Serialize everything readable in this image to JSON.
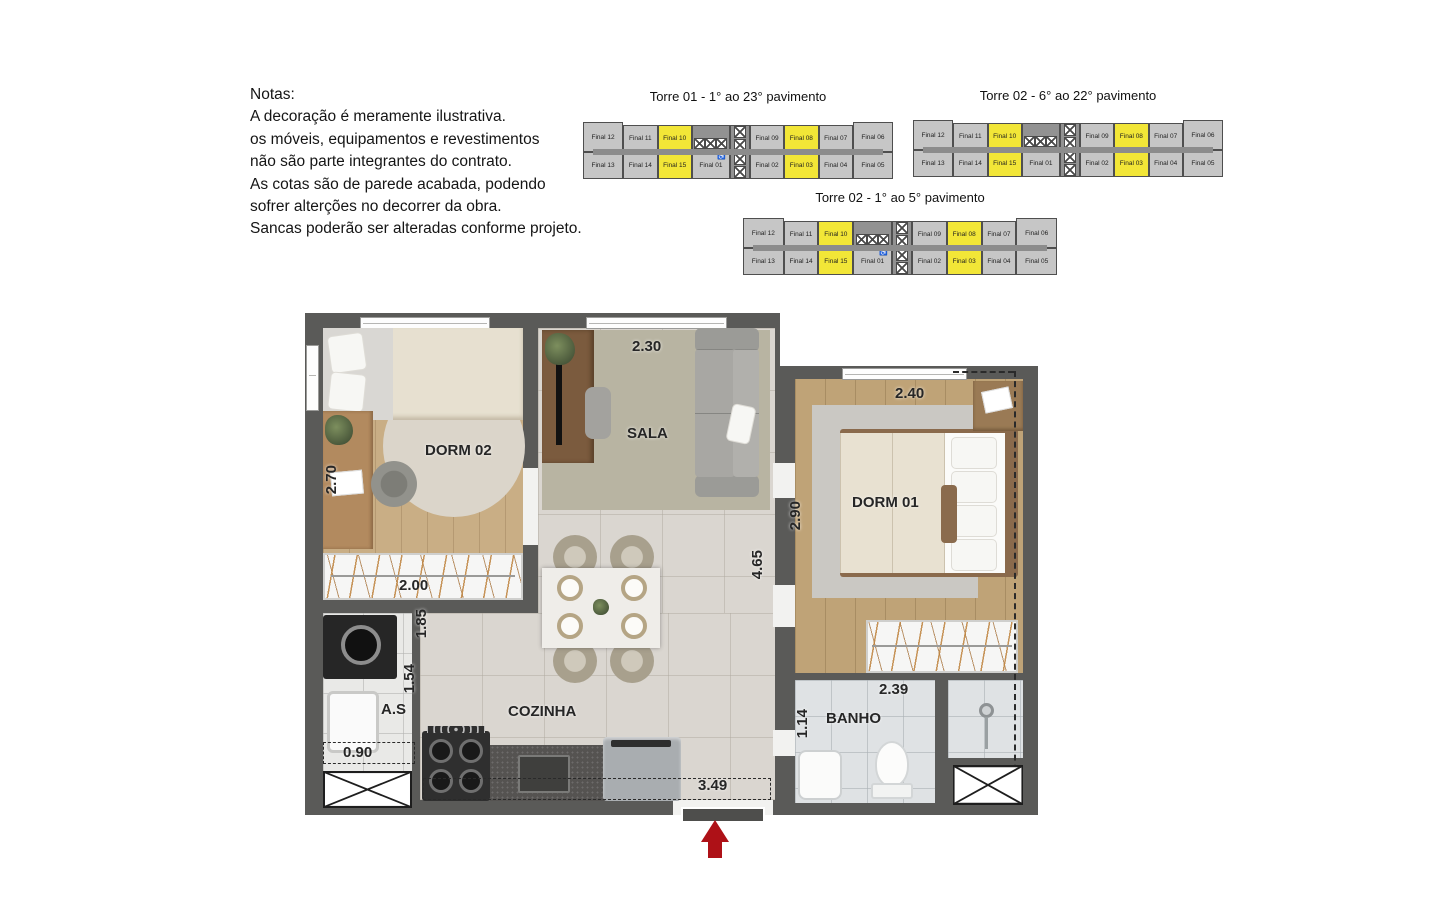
{
  "notes": {
    "title": "Notas:",
    "lines": [
      "A decoração é meramente ilustrativa.",
      "os móveis, equipamentos e revestimentos",
      "não são parte integrantes do contrato.",
      "As cotas são de parede acabada, podendo",
      "sofrer alterções no decorrer da obra.",
      "Sancas poderão ser alteradas conforme projeto."
    ]
  },
  "towers": [
    {
      "title": "Torre 01 - 1° ao 23° pavimento",
      "top_row": [
        {
          "label": "Final 12",
          "type": "unit",
          "end": true
        },
        {
          "label": "Final 11",
          "type": "unit"
        },
        {
          "label": "Final 10",
          "type": "unit",
          "hl": true
        },
        {
          "type": "stairs"
        },
        {
          "type": "elev"
        },
        {
          "label": "Final 09",
          "type": "unit"
        },
        {
          "label": "Final 08",
          "type": "unit",
          "hl": true
        },
        {
          "label": "Final 07",
          "type": "unit"
        },
        {
          "label": "Final 06",
          "type": "unit",
          "end": true
        }
      ],
      "bottom_row": [
        {
          "label": "Final 13",
          "type": "unit",
          "end": true
        },
        {
          "label": "Final 14",
          "type": "unit"
        },
        {
          "label": "Final 15",
          "type": "unit",
          "hl": true
        },
        {
          "label": "Final 01",
          "type": "unit",
          "f01": true,
          "acc": true
        },
        {
          "type": "elev"
        },
        {
          "label": "Final 02",
          "type": "unit"
        },
        {
          "label": "Final 03",
          "type": "unit",
          "hl": true
        },
        {
          "label": "Final 04",
          "type": "unit"
        },
        {
          "label": "Final 05",
          "type": "unit",
          "end": true
        }
      ]
    },
    {
      "title": "Torre 02 - 6° ao 22° pavimento",
      "top_row": [
        {
          "label": "Final 12",
          "type": "unit",
          "end": true
        },
        {
          "label": "Final 11",
          "type": "unit"
        },
        {
          "label": "Final 10",
          "type": "unit",
          "hl": true
        },
        {
          "type": "stairs"
        },
        {
          "type": "elev"
        },
        {
          "label": "Final 09",
          "type": "unit"
        },
        {
          "label": "Final 08",
          "type": "unit",
          "hl": true
        },
        {
          "label": "Final 07",
          "type": "unit"
        },
        {
          "label": "Final 06",
          "type": "unit",
          "end": true
        }
      ],
      "bottom_row": [
        {
          "label": "Final 13",
          "type": "unit",
          "end": true
        },
        {
          "label": "Final 14",
          "type": "unit"
        },
        {
          "label": "Final 15",
          "type": "unit",
          "hl": true
        },
        {
          "label": "Final 01",
          "type": "unit",
          "f01": true,
          "acc": false
        },
        {
          "type": "elev"
        },
        {
          "label": "Final 02",
          "type": "unit"
        },
        {
          "label": "Final 03",
          "type": "unit",
          "hl": true
        },
        {
          "label": "Final 04",
          "type": "unit"
        },
        {
          "label": "Final 05",
          "type": "unit",
          "end": true
        }
      ]
    },
    {
      "title": "Torre 02 - 1° ao 5° pavimento",
      "top_row": [
        {
          "label": "Final 12",
          "type": "unit",
          "end": true
        },
        {
          "label": "Final 11",
          "type": "unit"
        },
        {
          "label": "Final 10",
          "type": "unit",
          "hl": true
        },
        {
          "type": "stairs"
        },
        {
          "type": "elev"
        },
        {
          "label": "Final 09",
          "type": "unit"
        },
        {
          "label": "Final 08",
          "type": "unit",
          "hl": true
        },
        {
          "label": "Final 07",
          "type": "unit"
        },
        {
          "label": "Final 06",
          "type": "unit",
          "end": true
        }
      ],
      "bottom_row": [
        {
          "label": "Final 13",
          "type": "unit",
          "end": true
        },
        {
          "label": "Final 14",
          "type": "unit"
        },
        {
          "label": "Final 15",
          "type": "unit",
          "hl": true
        },
        {
          "label": "Final 01",
          "type": "unit",
          "f01": true,
          "acc": true
        },
        {
          "type": "elev"
        },
        {
          "label": "Final 02",
          "type": "unit"
        },
        {
          "label": "Final 03",
          "type": "unit",
          "hl": true
        },
        {
          "label": "Final 04",
          "type": "unit"
        },
        {
          "label": "Final 05",
          "type": "unit",
          "end": true
        }
      ]
    }
  ],
  "floorplan": {
    "rooms": {
      "dorm02": "DORM 02",
      "sala": "SALA",
      "dorm01": "DORM 01",
      "cozinha": "COZINHA",
      "as": "A.S",
      "banho": "BANHO"
    },
    "dims": {
      "sala_w": "2.30",
      "dorm02_h": "2.70",
      "closet_w": "2.00",
      "kitchen_a": "1.85",
      "kitchen_b": "1.54",
      "as_w": "0.90",
      "kitchen_w": "3.49",
      "living_h": "4.65",
      "dorm01_w": "2.40",
      "dorm01_h": "2.90",
      "banho_w": "2.39",
      "banho_h": "1.14"
    }
  },
  "colors": {
    "highlight_unit": "#F2E637",
    "tower_unit": "#C6C6C6",
    "tower_core": "#929292",
    "wall": "#5A5A58",
    "entry_arrow": "#AE1117"
  }
}
